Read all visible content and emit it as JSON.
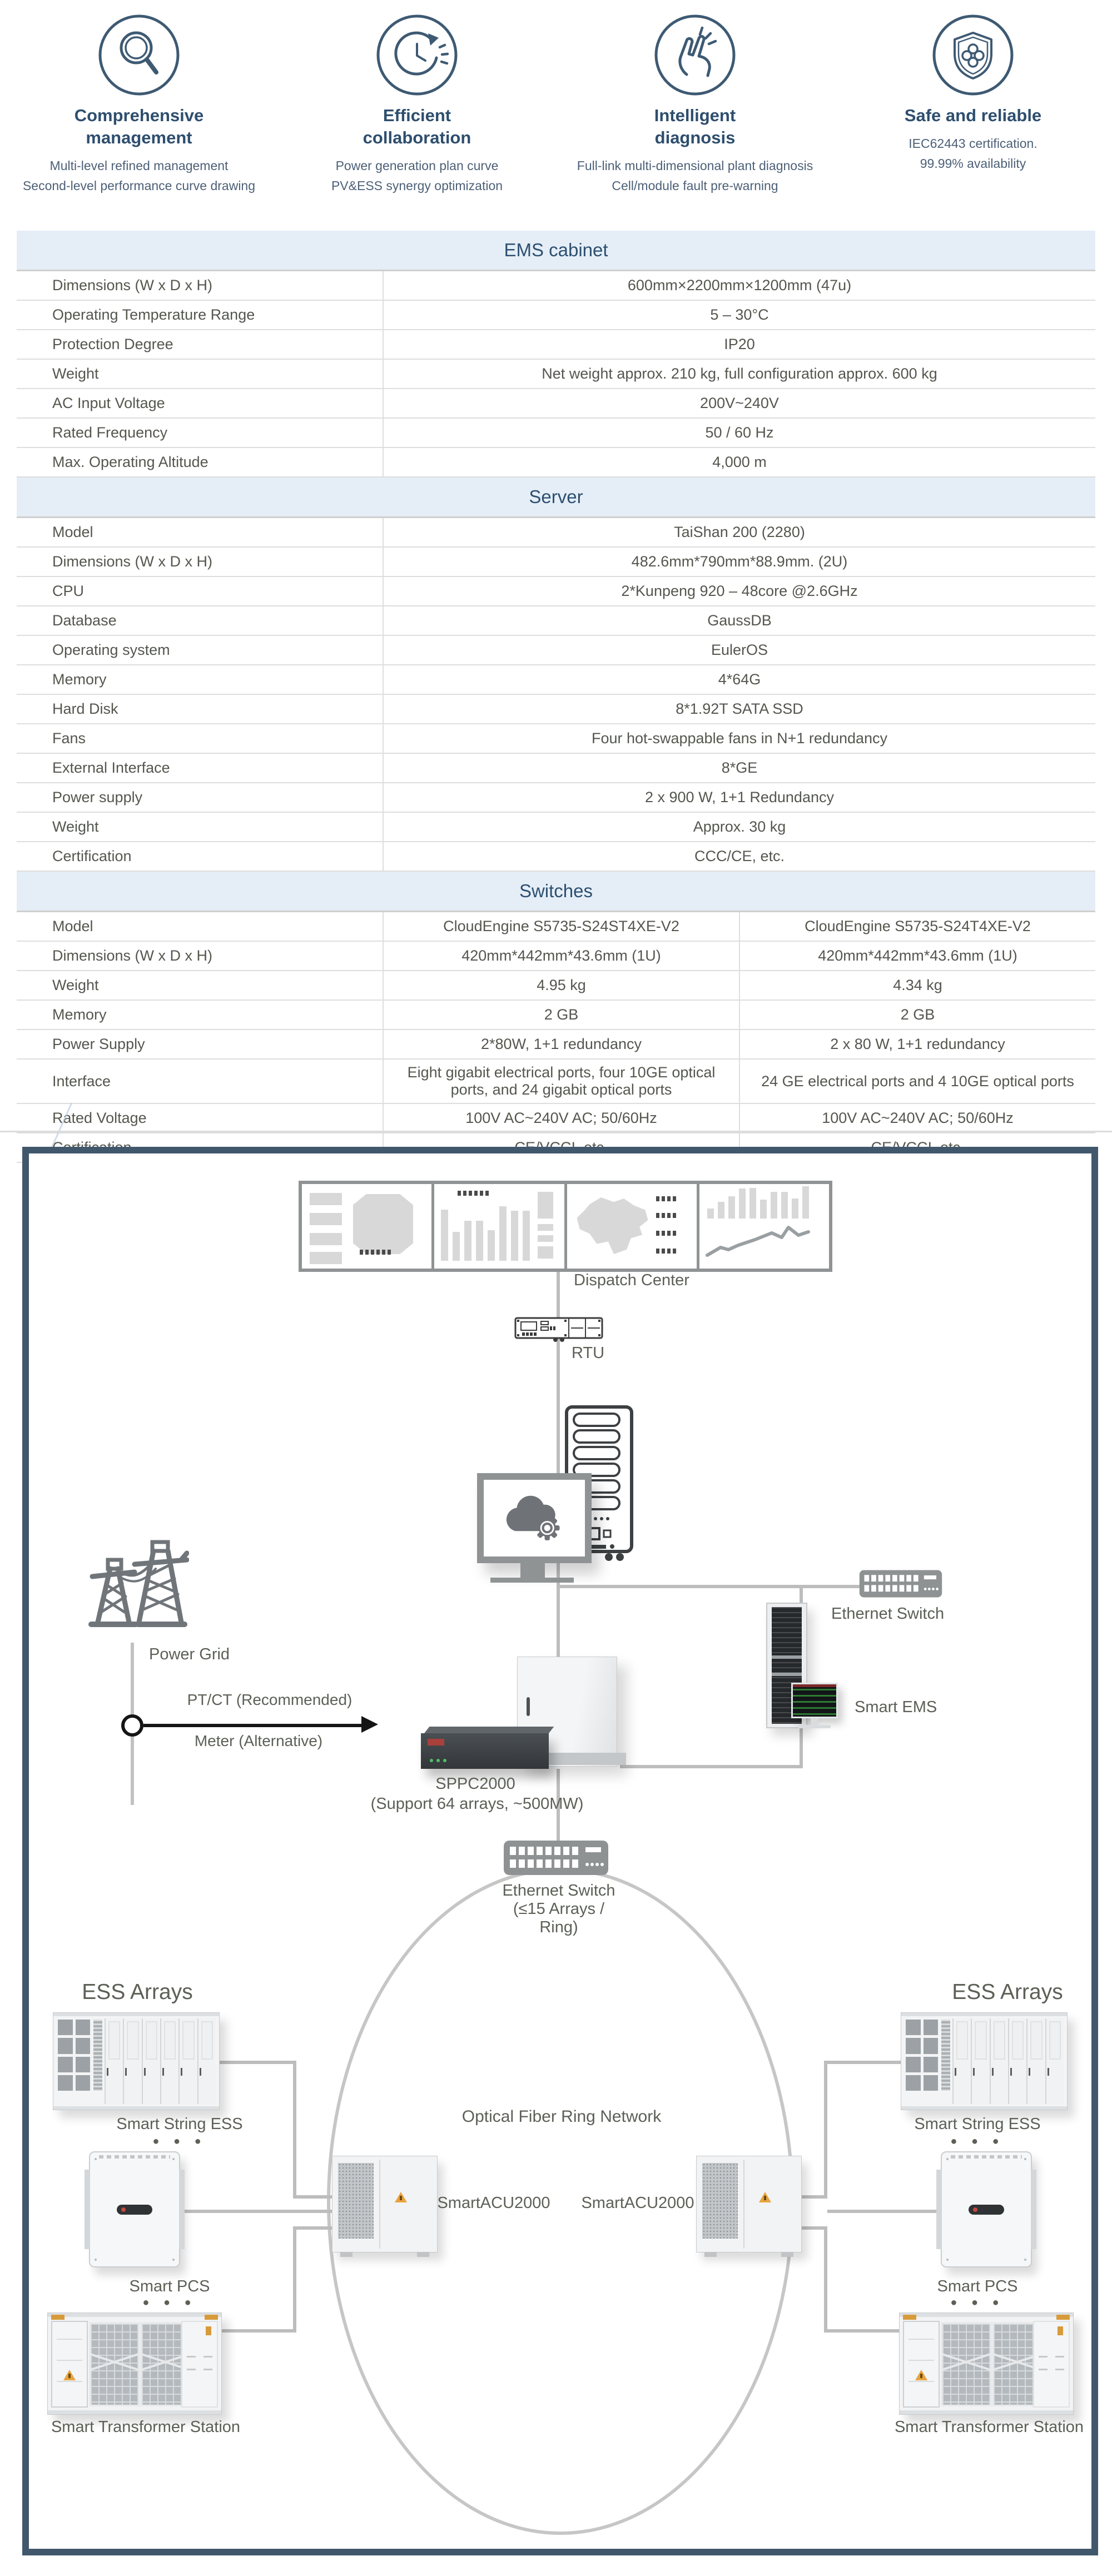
{
  "features": [
    {
      "icon": "magnifier-icon",
      "title_lines": [
        "Comprehensive",
        "management"
      ],
      "subtitles": [
        "Multi-level refined management",
        "Second-level performance curve drawing"
      ]
    },
    {
      "icon": "efficiency-clock-icon",
      "title_lines": [
        "Efficient",
        "collaboration"
      ],
      "subtitles": [
        "Power generation plan curve",
        "PV&ESS  synergy optimization"
      ]
    },
    {
      "icon": "snap-finger-icon",
      "title_lines": [
        "Intelligent",
        "diagnosis"
      ],
      "subtitles": [
        "Full-link multi-dimensional plant diagnosis",
        "Cell/module fault pre-warning"
      ]
    },
    {
      "icon": "shield-icon",
      "title_lines": [
        "Safe and reliable",
        ""
      ],
      "subtitles": [
        "IEC62443 certification.",
        "99.99% availability"
      ]
    }
  ],
  "tables": [
    {
      "id": "ems",
      "title": "EMS cabinet",
      "rows": [
        [
          "Dimensions (W x D x H)",
          "600mm×2200mm×1200mm (47u)"
        ],
        [
          "Operating Temperature Range",
          "5 – 30°C"
        ],
        [
          "Protection Degree",
          "IP20"
        ],
        [
          "Weight",
          "Net weight approx. 210 kg, full configuration approx. 600 kg"
        ],
        [
          "AC Input Voltage",
          "200V~240V"
        ],
        [
          "Rated Frequency",
          "50 / 60 Hz"
        ],
        [
          "Max. Operating Altitude",
          "4,000 m"
        ]
      ]
    },
    {
      "id": "server",
      "title": "Server",
      "rows": [
        [
          "Model",
          "TaiShan 200 (2280)"
        ],
        [
          "Dimensions (W x D x H)",
          "482.6mm*790mm*88.9mm. (2U)"
        ],
        [
          "CPU",
          "2*Kunpeng 920 – 48core @2.6GHz"
        ],
        [
          "Database",
          "GaussDB"
        ],
        [
          "Operating system",
          "EulerOS"
        ],
        [
          "Memory",
          "4*64G"
        ],
        [
          "Hard Disk",
          "8*1.92T SATA SSD"
        ],
        [
          "Fans",
          "Four hot-swappable fans in N+1 redundancy"
        ],
        [
          "External Interface",
          "8*GE"
        ],
        [
          "Power supply",
          "2 x 900 W, 1+1 Redundancy"
        ],
        [
          "Weight",
          "Approx. 30 kg"
        ],
        [
          "Certification",
          "CCC/CE, etc."
        ]
      ]
    },
    {
      "id": "switches",
      "title": "Switches",
      "rows": [
        [
          "Model",
          "CloudEngine S5735-S24ST4XE-V2",
          "CloudEngine S5735-S24T4XE-V2"
        ],
        [
          "Dimensions (W x D x H)",
          "420mm*442mm*43.6mm (1U)",
          "420mm*442mm*43.6mm (1U)"
        ],
        [
          "Weight",
          "4.95 kg",
          "4.34 kg"
        ],
        [
          "Memory",
          "2 GB",
          "2 GB"
        ],
        [
          "Power Supply",
          "2*80W, 1+1 redundancy",
          "2 x 80 W, 1+1 redundancy"
        ],
        [
          "Interface",
          "Eight gigabit electrical ports, four 10GE optical ports, and 24 gigabit optical ports",
          "24 GE electrical ports and 4 10GE optical ports"
        ],
        [
          "Rated Voltage",
          "100V AC~240V AC; 50/60Hz",
          "100V AC~240V AC; 50/60Hz"
        ],
        [
          "Certification",
          "CE/VCCI, etc.",
          "CE/VCCI, etc."
        ]
      ]
    }
  ],
  "diagram": {
    "dispatch_center": "Dispatch Center",
    "rtu": "RTU",
    "power_grid": "Power Grid",
    "ptct": "PT/CT (Recommended)",
    "meter": "Meter (Alternative)",
    "ethernet_switch_top": "Ethernet Switch",
    "smart_ems": "Smart EMS",
    "sppc": "SPPC2000",
    "sppc_sub": "(Support 64 arrays, ~500MW)",
    "ring_switch_line1": "Ethernet Switch",
    "ring_switch_line2": "(≤15 Arrays /",
    "ring_switch_line3": "Ring)",
    "ring_label": "Optical Fiber Ring Network",
    "acu_left": "SmartACU2000",
    "acu_right": "SmartACU2000",
    "ess_arrays_left": "ESS Arrays",
    "ess_arrays_right": "ESS Arrays",
    "smart_string_ess_left": "Smart String ESS",
    "smart_string_ess_right": "Smart String ESS",
    "smart_pcs_left": "Smart PCS",
    "smart_pcs_right": "Smart PCS",
    "transformer_left": "Smart Transformer Station",
    "transformer_right": "Smart Transformer Station",
    "dots": "●  ●  ●"
  },
  "colors": {
    "accent_slate": "#3e5a73",
    "band_blue": "#e5eef7",
    "title_blue": "#2d4f70",
    "line_gray": "#bdbdbd",
    "warn_orange": "#e8a33d"
  }
}
